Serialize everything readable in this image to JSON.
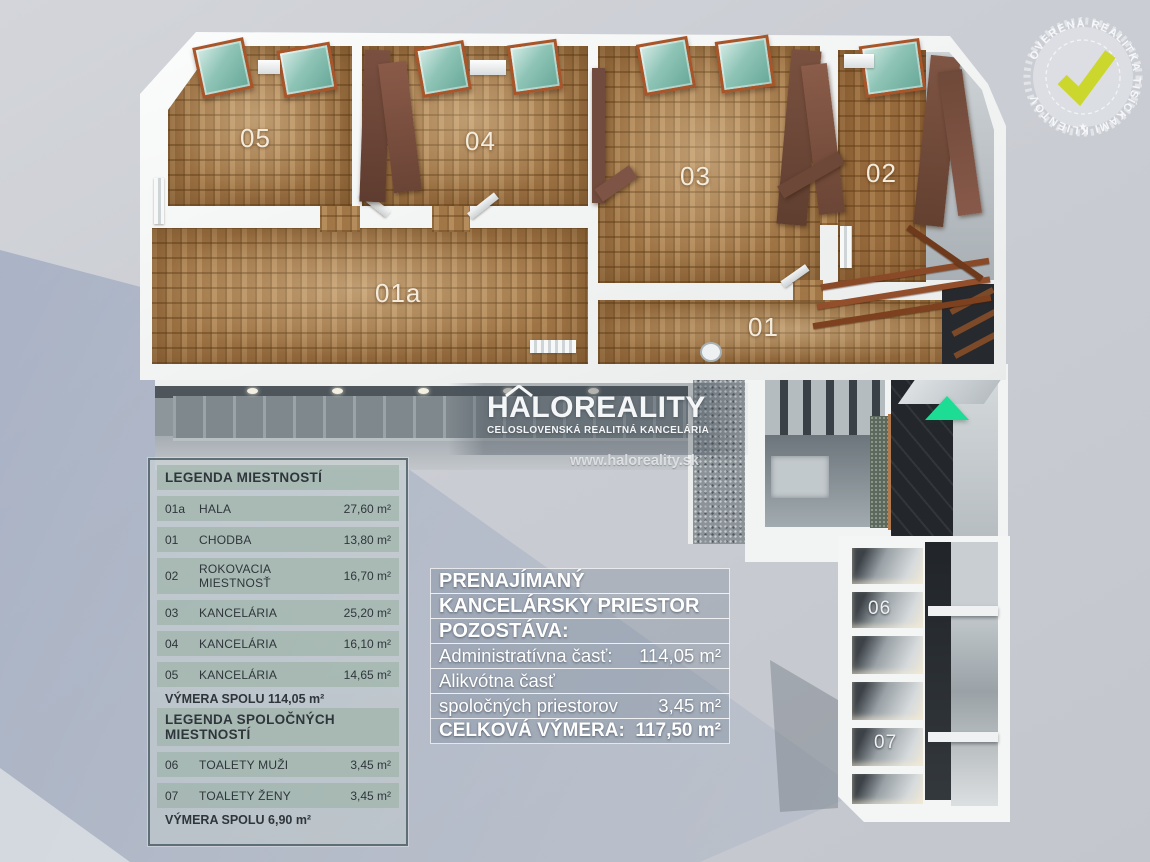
{
  "plan": {
    "rooms": {
      "r05": "05",
      "r04": "04",
      "r03": "03",
      "r02": "02",
      "r01a": "01a",
      "r01": "01",
      "r06": "06",
      "r07": "07"
    },
    "entrance_arrow_color": "#1ddd95"
  },
  "logo": {
    "brand": "HALOREALITY",
    "subtitle": "CELOSLOVENSKÁ REALITNÁ KANCELÁRIA",
    "website": "www.haloreality.sk"
  },
  "badge": {
    "circular_text": "OVERENÁ REALITKA TISÍCKAMI KLIENTOV",
    "star": "★",
    "check_color": "#ccd72e"
  },
  "legend": {
    "title": "LEGENDA MIESTNOSTÍ",
    "rooms": [
      {
        "id": "01a",
        "name": "HALA",
        "area": "27,60 m²"
      },
      {
        "id": "01",
        "name": "CHODBA",
        "area": "13,80 m²"
      },
      {
        "id": "02",
        "name": "ROKOVACIA MIESTNOSŤ",
        "area": "16,70 m²"
      },
      {
        "id": "03",
        "name": "KANCELÁRIA",
        "area": "25,20 m²"
      },
      {
        "id": "04",
        "name": "KANCELÁRIA",
        "area": "16,10 m²"
      },
      {
        "id": "05",
        "name": "KANCELÁRIA",
        "area": "14,65 m²"
      }
    ],
    "total": "VÝMERA SPOLU 114,05 m²",
    "shared_title": "LEGENDA SPOLOČNÝCH MIESTNOSTÍ",
    "shared_rooms": [
      {
        "id": "06",
        "name": "TOALETY MUŽI",
        "area": "3,45 m²"
      },
      {
        "id": "07",
        "name": "TOALETY ŽENY",
        "area": "3,45 m²"
      }
    ],
    "shared_total": "VÝMERA SPOLU 6,90 m²"
  },
  "info": {
    "headers": [
      "PRENAJÍMANÝ",
      "KANCELÁRSKY PRIESTOR",
      "POZOSTÁVA:"
    ],
    "rows": [
      {
        "label": "Administratívna časť:",
        "value": "114,05 m²"
      },
      {
        "label": "Alikvótna časť",
        "value": ""
      },
      {
        "label": "spoločných priestorov",
        "value": "3,45 m²"
      },
      {
        "label": "CELKOVÁ VÝMERA:",
        "value": "117,50 m²"
      }
    ]
  }
}
